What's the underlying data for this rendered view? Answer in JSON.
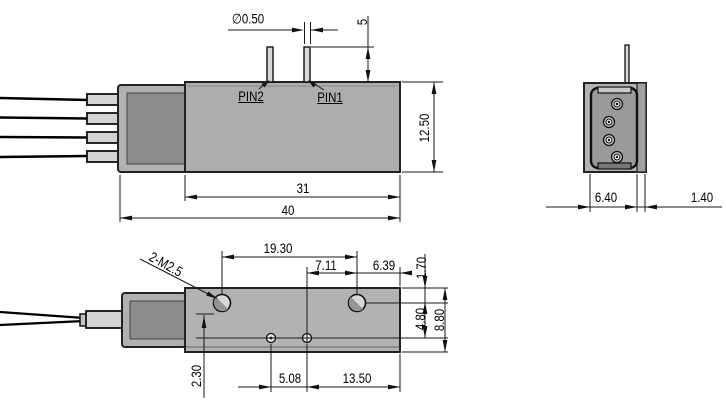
{
  "side_view": {
    "name": "side view",
    "pin_labels": {
      "pin1": "PIN1",
      "pin2": "PIN2"
    },
    "dims": {
      "pin_diameter": "∅0.50",
      "pin_height": "5",
      "body_height": "12.50",
      "body_length": "31",
      "overall_length": "40"
    }
  },
  "end_view": {
    "name": "end view",
    "dims": {
      "body_width": "6.40",
      "cover_width": "1.40"
    }
  },
  "top_view": {
    "name": "top view",
    "thread_callout": "2-M2.5",
    "dims": {
      "mount_hole_spacing": "19.30",
      "small_hole_to_mount_hole": "7.11",
      "mount_hole_to_edge": "6.39",
      "edge_to_hole_row": "1.70",
      "hole_row_to_centerline": "4.80",
      "overall_width": "8.80",
      "centerline_to_edge": "2.30",
      "small_hole_spacing": "5.08",
      "small_hole_to_end": "13.50"
    }
  },
  "colors": {
    "body_fill": "#b2b2b2",
    "connector_face": "#8d8d8d",
    "ferrule_fill": "#d4d4d4",
    "cavity_fill": "#9a9a9a",
    "line": "#1a1a1a",
    "fiber": "#000000"
  }
}
